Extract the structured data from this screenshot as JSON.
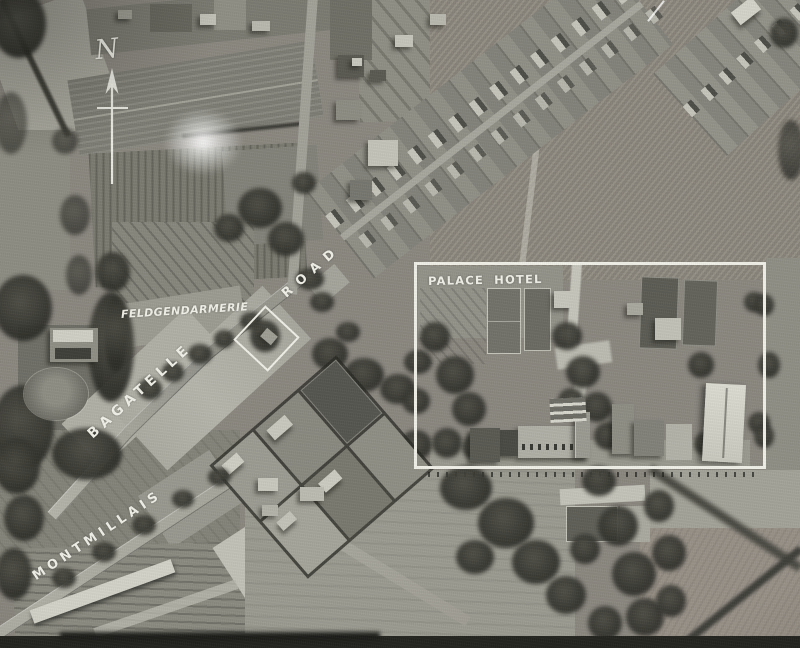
{
  "annotations": {
    "color": "#f1f1e9",
    "north": {
      "letter": "N"
    },
    "labels": {
      "palace_hotel": "PALACE HOTEL",
      "feldgendarmerie": "FELDGENDARMERIE"
    },
    "road_names": {
      "bagatelle": "BAGATELLE",
      "road": "ROAD",
      "montmillais": "MONTMILLAIS"
    }
  }
}
